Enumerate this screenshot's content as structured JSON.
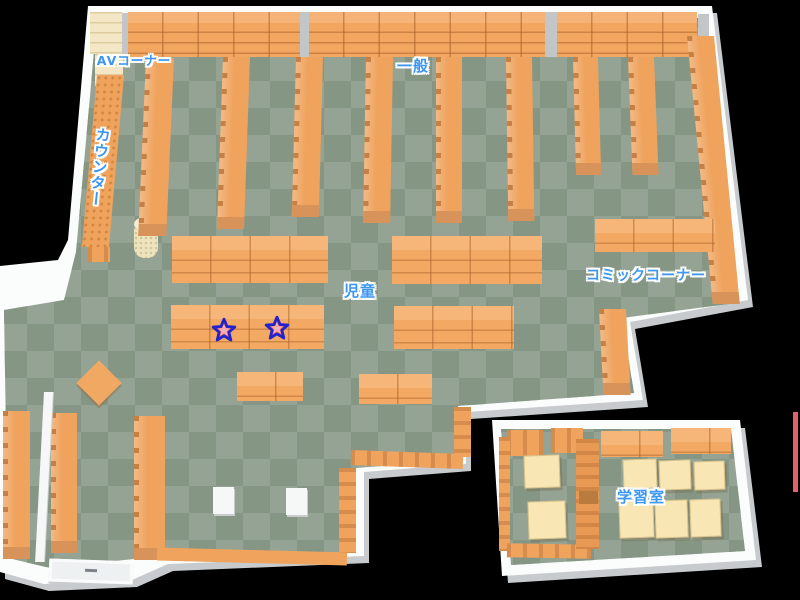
{
  "map": {
    "kind": "library-floor-map",
    "areas": [
      {
        "id": "av-corner",
        "label": "AVコーナー"
      },
      {
        "id": "counter",
        "label": "カウンター"
      },
      {
        "id": "general",
        "label": "一般"
      },
      {
        "id": "children",
        "label": "児童"
      },
      {
        "id": "comic-corner",
        "label": "コミックコーナー"
      },
      {
        "id": "study-room",
        "label": "学習室"
      }
    ],
    "markers": [
      {
        "id": "star-1",
        "shape": "star",
        "area": "children"
      },
      {
        "id": "star-2",
        "shape": "star",
        "area": "children"
      }
    ],
    "colors": {
      "background": "#000000",
      "floor_checker_dark": "#869685",
      "floor_checker_light": "#94A393",
      "shelf_orange": "#F2A660",
      "shelf_orange_dark": "#D8935A",
      "shelf_cream": "#F3E7C6",
      "desk_cream": "#F8E7B5",
      "wall_white": "#FBFDFD",
      "wall_shadow": "#C7CBCD",
      "label_blue": "#3B97F3",
      "label_outline": "#FFFFFF",
      "star_fill": "#E96A6A",
      "star_highlight": "#F7ADAD",
      "star_outline": "#2323CC",
      "edge_accent_red": "#E2606C"
    }
  }
}
